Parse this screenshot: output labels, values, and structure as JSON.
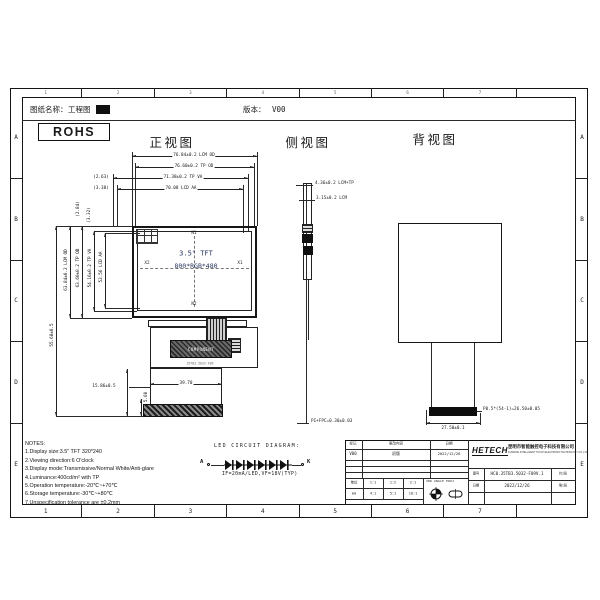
{
  "header": {
    "doc_label": "图纸名称：",
    "doc_name": "工程图",
    "version_label": "版本：",
    "version": "V00"
  },
  "rohs": "ROHS",
  "zones": {
    "cols": [
      "1",
      "2",
      "3",
      "4",
      "5",
      "6",
      "7",
      ""
    ],
    "rows": [
      "A",
      "B",
      "C",
      "D",
      "E"
    ]
  },
  "front": {
    "title": "正视图",
    "top_dims": [
      "76.84±0.2 LCM OD",
      "76.60±0.2 TP OD",
      "71.38±0.2 TP VA",
      "70.08 LCD AA"
    ],
    "top_refs": [
      "(2.63)",
      "(3.38)"
    ],
    "left_dims": [
      "63.84±0.2 LCM OD",
      "63.60±0.2 TP OD",
      "54.16±0.2 TP VA",
      "52.56 LCD AA"
    ],
    "left_refs": [
      "(2.84)",
      "(3.32)"
    ],
    "height_dim": "55.68±0.5",
    "tail_dim_a": "15.86±0.5",
    "tail_dim_b": "39.70",
    "tail_dim_c": "5.60",
    "panel_line1": "3.5\" TFT",
    "panel_line2": "800*RGB*480",
    "mark_top": "N1",
    "mark_bottom": "N2",
    "mark_left": "X2",
    "mark_right": "X1",
    "component_label": "COMPONENT",
    "component_sub": "35TB3.5032-F09"
  },
  "side": {
    "title": "侧视图",
    "dim1": "4.36±0.2 LCM+TP",
    "dim2": "3.15±0.2 LCM",
    "dim3": "PI+FPC=0.30±0.03"
  },
  "back": {
    "title": "背视图",
    "dim1": "P0.5*(54-1)=26.50±0.05",
    "dim2": "27.50±0.1"
  },
  "notes": {
    "title": "NOTES:",
    "items": [
      "1.Display size:3.5\" TFT 320*240",
      "2.Viewing direction:6 O'clock",
      "3.Display mode:Transmissive/Normal White/Anti-glare",
      "4.Luminance:400cd/m² with TP",
      "5.Operation temperature:-20℃~+70℃",
      "6.Storage temperature:-30℃~+80℃",
      "7.Unspecification tolerance are ±0.2mm"
    ]
  },
  "led": {
    "title": "LED CIRCUIT DIAGRAM:",
    "anode": "A",
    "cathode": "K",
    "spec": "IF=20mA/LED,VF=18V(TYP)"
  },
  "titleblock": {
    "rev_headers": [
      "标记",
      "更改内容",
      "日期"
    ],
    "rev_row": [
      "V00",
      "初版",
      "2022/12/26"
    ],
    "scale_r1": [
      "单位",
      "1:1",
      "1:2",
      "2:1"
    ],
    "scale_r2": [
      "mm",
      "4:1",
      "5:1",
      "10:1"
    ],
    "angle": "3RD ANGLE PROJ",
    "logo": "HETECH",
    "company_cn": "昆明市智能触控电子科技有限公司",
    "company_en": "KUNMING INTELLIGENT TOUCH ELECTRONIC TECHNOLOGY CO.,LTD",
    "pn_label": "图号",
    "pn": "HC0.35TB3.5032-F09V.1",
    "date_label": "日期",
    "date": "2022/12/26",
    "sheet_total": "共1张",
    "sheet_no": "第1张"
  }
}
